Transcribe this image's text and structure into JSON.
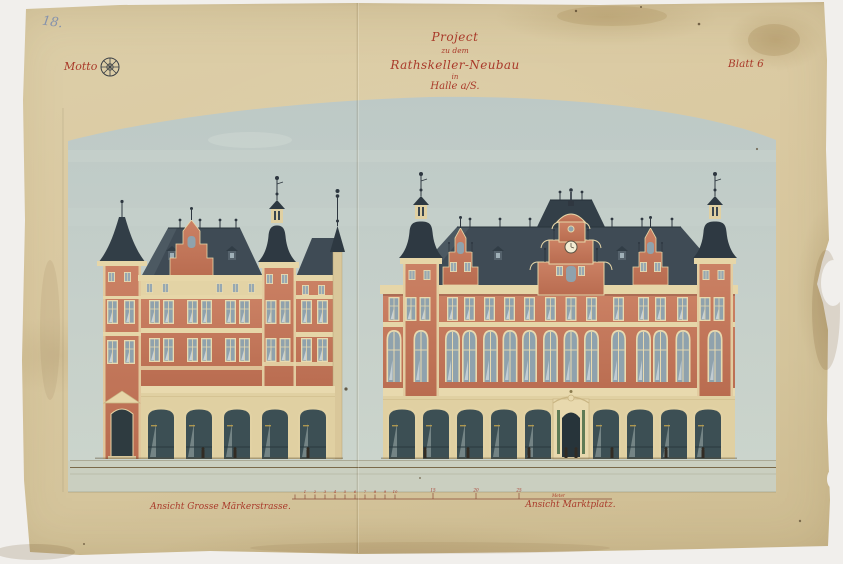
{
  "page_number": "18.",
  "header": {
    "motto_label": "Motto",
    "motto_stamp_icon": "wheel-stamp",
    "title_lines": [
      "Project",
      "zu dem",
      "Rathskeller-Neubau",
      "in",
      "Halle a/S."
    ],
    "sheet_number": "Blatt 6"
  },
  "elevations": {
    "left_caption": "Ansicht Grosse Märkerstrasse.",
    "right_caption": "Ansicht Marktplatz."
  },
  "scale_bar": {
    "ticks": [
      "1",
      "2",
      "3",
      "4",
      "5",
      "6",
      "7",
      "8",
      "9",
      "10"
    ],
    "marks": [
      "15",
      "20",
      "25"
    ],
    "unit": "Meter"
  },
  "colors": {
    "paper": "#d8c8a0",
    "sky_wash": "#c3cdc7",
    "brick": "#c5795d",
    "stone": "#e6d6a8",
    "roof_slate": "#3f4b55",
    "ink_red": "#a93a2a",
    "pencil_blue": "#8592ac"
  }
}
